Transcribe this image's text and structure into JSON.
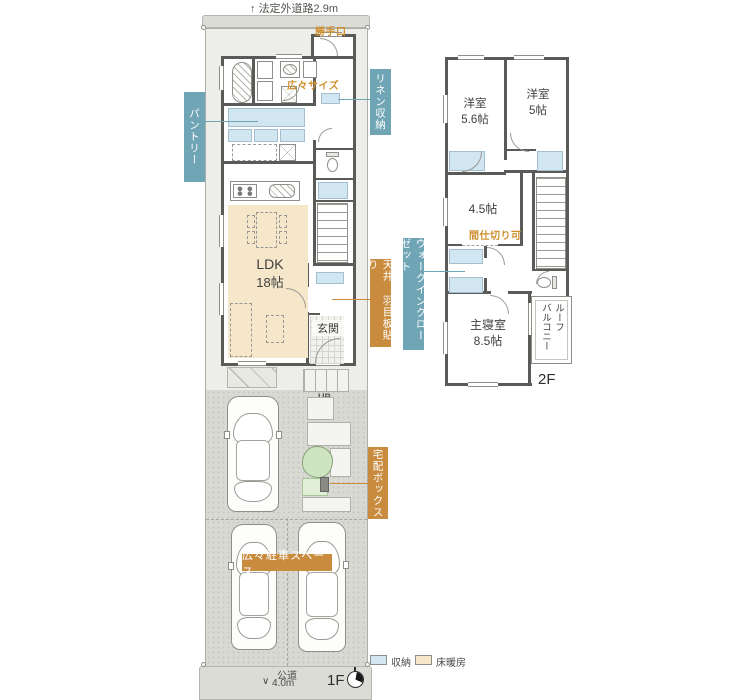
{
  "colors": {
    "wall": "#5a5a58",
    "storage_fill": "#d2e6f2",
    "floor_heating_fill": "#f6e7cb",
    "blue_label_bg": "#6fa5b5",
    "orange_label_bg": "#c98c3f",
    "orange_note_text": "#cf8f2e",
    "driveway": "#d9d9d4",
    "tree_green": "#cfe4c1"
  },
  "site": {
    "road_top_arrow": "↑",
    "road_top_label": "法定外道路2.9m",
    "road_bottom_arrow": "∨",
    "road_bottom_name": "公道",
    "road_bottom_width": "4.0m"
  },
  "f1": {
    "floor_label": "1F",
    "katteguchi": "勝手口",
    "size_note": "広々サイズ",
    "pantry": "パントリー",
    "linen": "リネン収納",
    "ldk_name": "LDK",
    "ldk_size": "18帖",
    "ceiling_note": "天井 羽目板貼り",
    "genkan": "玄関",
    "up": "UP",
    "delivery_box": "宅配ボックス",
    "parking_note": "広々駐車スペース"
  },
  "f2": {
    "floor_label": "2F",
    "bedroom1_name": "洋室",
    "bedroom1_size": "5.6帖",
    "bedroom2_name": "洋室",
    "bedroom2_size": "5帖",
    "room45_size": "4.5帖",
    "partition_note": "間仕切り可",
    "wic": "ウォークインクローゼット",
    "master_name": "主寝室",
    "master_size": "8.5帖",
    "balcony_col_right": "ルーフ",
    "balcony_col_left": "バルコニー"
  },
  "legend": {
    "storage": "収納",
    "floor_heating": "床暖房"
  }
}
